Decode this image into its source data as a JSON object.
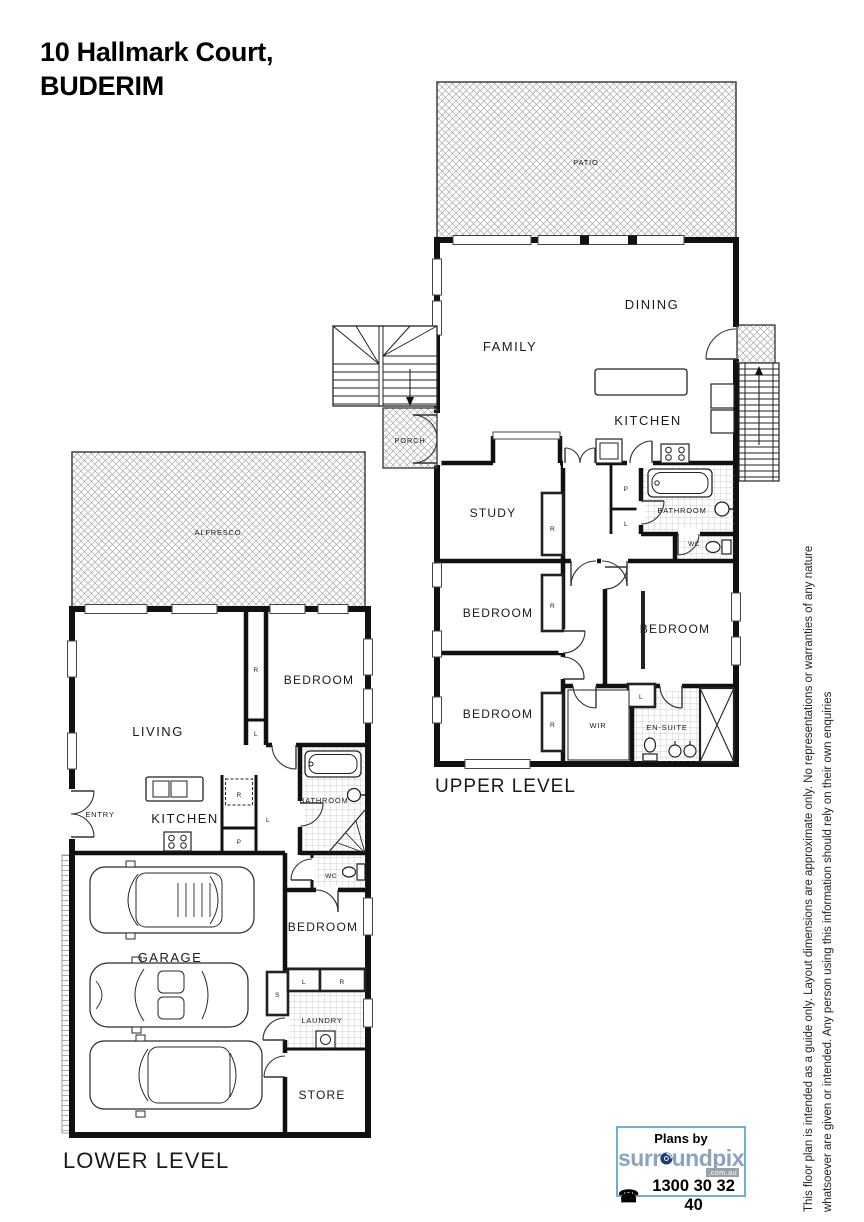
{
  "title": {
    "line1": "10 Hallmark Court,",
    "line2": "BUDERIM"
  },
  "upper": {
    "caption": "UPPER LEVEL",
    "labels": {
      "patio": "PATIO",
      "dining": "DINING",
      "family": "FAMILY",
      "kitchen": "KITCHEN",
      "porch": "PORCH",
      "study": "STUDY",
      "bathroom": "BATHROOM",
      "wc": "WC",
      "bedroom_mid": "BEDROOM",
      "bedroom_right": "BEDROOM",
      "bedroom_lower": "BEDROOM",
      "wir": "WIR",
      "ensuite": "EN-SUITE",
      "robe_study": "R",
      "robe_mid": "R",
      "robe_lower": "R",
      "pantry": "P",
      "linen_hall": "L",
      "linen_ensuite": "L"
    }
  },
  "lower": {
    "caption": "LOWER LEVEL",
    "labels": {
      "alfresco": "ALFRESCO",
      "living": "LIVING",
      "entry": "ENTRY",
      "kitchen": "KITCHEN",
      "bedroom_upper": "BEDROOM",
      "bathroom": "BATHROOM",
      "wc": "WC",
      "garage": "GARAGE",
      "bedroom_lower": "BEDROOM",
      "laundry": "LAUNDRY",
      "store": "STORE",
      "robe_bedroom": "R",
      "linen_bedroom": "L",
      "fridge": "R",
      "linen_hall": "L",
      "pantry": "P",
      "store_cupboard": "S",
      "linen_laundry": "L",
      "robe_laundry": "R"
    }
  },
  "disclaimer": {
    "line1": "This floor plan is intended as a guide only. Layout dimensions are approximate only. No representations or warranties of any nature",
    "line2": "whatsoever are given or intended. Any person using this information should rely on their own enquiries"
  },
  "branding": {
    "plans_by": "Plans by",
    "name": "surroundpix",
    "name_pre": "surr",
    "name_post": "undpix",
    "tld": ".com.au",
    "phone": "1300 30 32 40",
    "border_color": "#6fb0d6",
    "name_color": "#8ca3bd",
    "o_color": "#1c3a7d"
  }
}
